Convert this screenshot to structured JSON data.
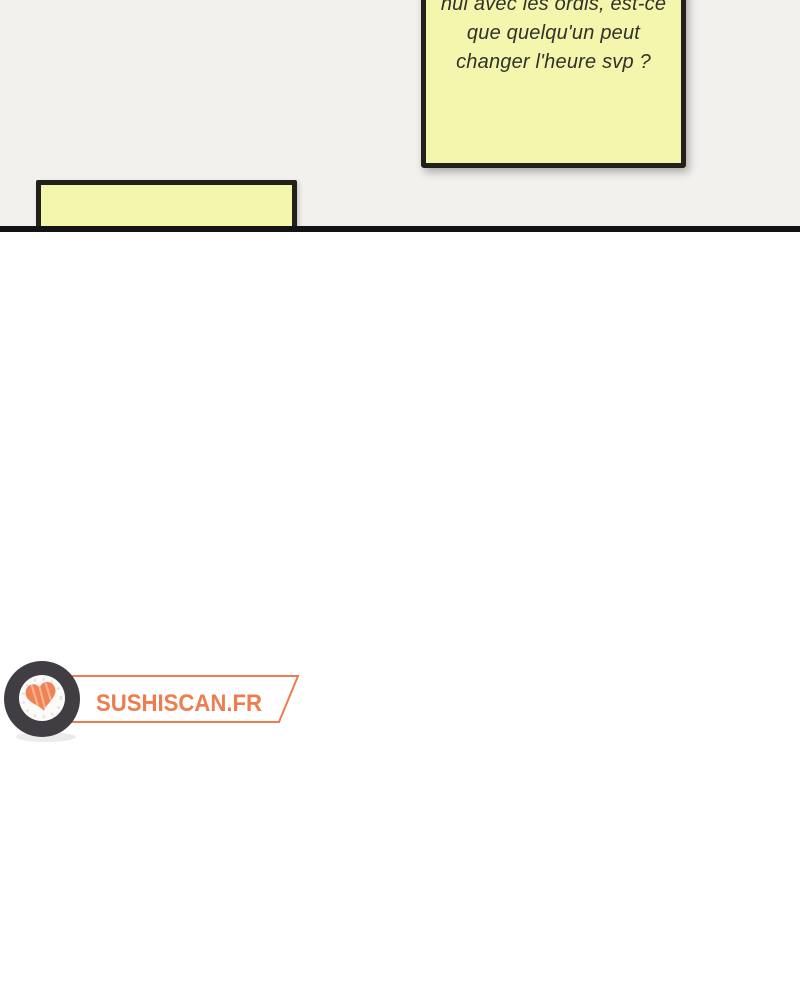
{
  "comic": {
    "sticky_note": {
      "text_lines": [
        "nul avec les ordis, est-ce",
        "que quelqu'un peut",
        "changer l'heure svp ?"
      ],
      "fill": "#f4f6ae",
      "border": "#21201a",
      "text_color": "#32312a"
    },
    "strip_panel": {
      "fill": "#f4f6ae",
      "border": "#21201a"
    },
    "background_top": "#f2f1ee",
    "background_bottom": "#ffffff",
    "divider_color": "#131313"
  },
  "logo": {
    "site_name": "SUSHISCAN.FR",
    "accent": "#ee7c4c",
    "roll_ring": "#413e43",
    "roll_fill": "#fcfbf9",
    "rice_texture": "#e4e2de",
    "salmon": "#ef8356",
    "salmon_light": "#f8b38c"
  }
}
